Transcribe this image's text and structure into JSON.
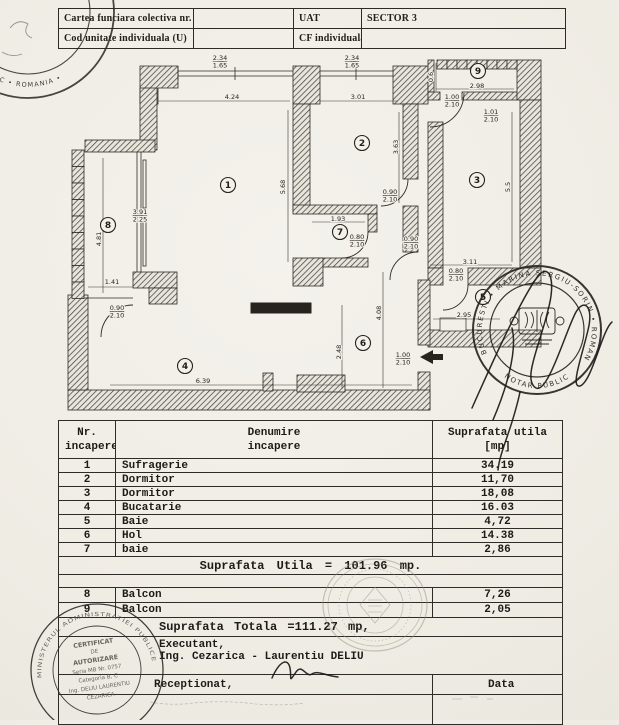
{
  "header_table": {
    "rows": [
      {
        "c1": "Cartea funciara colectiva nr.",
        "c2": "",
        "c3": "UAT",
        "c4": "SECTOR 3"
      },
      {
        "c1": "Cod unitate individuala (U)",
        "c2": "",
        "c3": "CF individuala",
        "c4": ""
      }
    ]
  },
  "plan": {
    "rooms": [
      {
        "n": "1",
        "x": 228,
        "y": 185
      },
      {
        "n": "2",
        "x": 362,
        "y": 143
      },
      {
        "n": "3",
        "x": 477,
        "y": 180
      },
      {
        "n": "4",
        "x": 185,
        "y": 366
      },
      {
        "n": "5",
        "x": 483,
        "y": 297
      },
      {
        "n": "6",
        "x": 363,
        "y": 343
      },
      {
        "n": "7",
        "x": 340,
        "y": 232
      },
      {
        "n": "8",
        "x": 108,
        "y": 225
      },
      {
        "n": "9",
        "x": 478,
        "y": 71
      }
    ],
    "dims": [
      {
        "x": 220,
        "y": 60,
        "lines": [
          "2.34",
          "1.65"
        ]
      },
      {
        "x": 352,
        "y": 60,
        "lines": [
          "2.34",
          "1.65"
        ]
      },
      {
        "x": 232,
        "y": 99,
        "lines": [
          "4.24"
        ]
      },
      {
        "x": 358,
        "y": 99,
        "lines": [
          "3.01"
        ]
      },
      {
        "x": 285,
        "y": 187,
        "rot": -90,
        "lines": [
          "5.68"
        ]
      },
      {
        "x": 398,
        "y": 147,
        "rot": -90,
        "lines": [
          "3.63"
        ]
      },
      {
        "x": 433,
        "y": 77,
        "rot": -90,
        "lines": [
          "0.6"
        ]
      },
      {
        "x": 477,
        "y": 88,
        "lines": [
          "2.98"
        ]
      },
      {
        "x": 452,
        "y": 99,
        "lines": [
          "1.00",
          "2.10"
        ]
      },
      {
        "x": 491,
        "y": 114,
        "lines": [
          "1.01",
          "2.10"
        ]
      },
      {
        "x": 510,
        "y": 187,
        "rot": -90,
        "lines": [
          "5.5"
        ]
      },
      {
        "x": 140,
        "y": 214,
        "lines": [
          "3.91",
          "2.25"
        ]
      },
      {
        "x": 101,
        "y": 239,
        "rot": -90,
        "lines": [
          "4.81"
        ]
      },
      {
        "x": 112,
        "y": 284,
        "lines": [
          "1.41"
        ]
      },
      {
        "x": 117,
        "y": 310,
        "lines": [
          "0.90",
          "2.10"
        ]
      },
      {
        "x": 338,
        "y": 221,
        "lines": [
          "1.93"
        ]
      },
      {
        "x": 390,
        "y": 194,
        "lines": [
          "0.90",
          "2.10"
        ]
      },
      {
        "x": 357,
        "y": 239,
        "lines": [
          "0.80",
          "2.10"
        ]
      },
      {
        "x": 411,
        "y": 241,
        "lines": [
          "0.90",
          "2.10"
        ]
      },
      {
        "x": 470,
        "y": 264,
        "lines": [
          "3.11"
        ]
      },
      {
        "x": 456,
        "y": 273,
        "lines": [
          "0.80",
          "2.10"
        ]
      },
      {
        "x": 464,
        "y": 317,
        "lines": [
          "2.95"
        ]
      },
      {
        "x": 381,
        "y": 313,
        "rot": -90,
        "lines": [
          "4.08"
        ]
      },
      {
        "x": 403,
        "y": 357,
        "lines": [
          "1.00",
          "2.10"
        ]
      },
      {
        "x": 203,
        "y": 383,
        "lines": [
          "6.39"
        ]
      },
      {
        "x": 341,
        "y": 352,
        "rot": -90,
        "lines": [
          "2.48"
        ]
      }
    ]
  },
  "table": {
    "header": {
      "c1a": "Nr.",
      "c1b": "incapere",
      "c2a": "Denumire",
      "c2b": "incapere",
      "c3a": "Suprafata utila",
      "c3b": "[mp]"
    },
    "rows": [
      {
        "nr": "1",
        "name": "Sufragerie",
        "area": "34.19"
      },
      {
        "nr": "2",
        "name": "Dormitor",
        "area": "11,70"
      },
      {
        "nr": "3",
        "name": "Dormitor",
        "area": "18,08"
      },
      {
        "nr": "4",
        "name": "Bucatarie",
        "area": "16.03"
      },
      {
        "nr": "5",
        "name": "Baie",
        "area": "4,72"
      },
      {
        "nr": "6",
        "name": "Hol",
        "area": "14.38"
      },
      {
        "nr": "7",
        "name": "baie",
        "area": "2,86"
      }
    ],
    "subtotal": "Suprafata Utila = 101.96 mp.",
    "rows2": [
      {
        "nr": "8",
        "name": "Balcon",
        "area": "7,26"
      },
      {
        "nr": "9",
        "name": "Balcon",
        "area": "2,05"
      }
    ],
    "total": "Suprafata Totala =111.27 mp,",
    "executant_label": "Executant,",
    "executant_name": "Ing. Cezarica - Laurentiu DELIU",
    "receptionat": "Receptionat,",
    "data_label": "Data"
  },
  "stamps": {
    "notary_topleft": {
      "ring": "NOTAR PUBLIC • ROMANIA •"
    },
    "notary_right": {
      "ring_top": "BUCURESTI • MARINA SERGIU-SORIN • ROMANIA",
      "ring_bottom": "NOTAR PUBLIC"
    },
    "certificate": {
      "ring": "MINISTERUL ADMINISTRATIEI PUBLICE",
      "lines": [
        "CERTIFICAT",
        "DE",
        "AUTORIZARE",
        "Seria MB Nr. 0757",
        "Categoria B, C",
        "Ing. DELIU LAURENTIU",
        "CEZARICA"
      ]
    }
  }
}
